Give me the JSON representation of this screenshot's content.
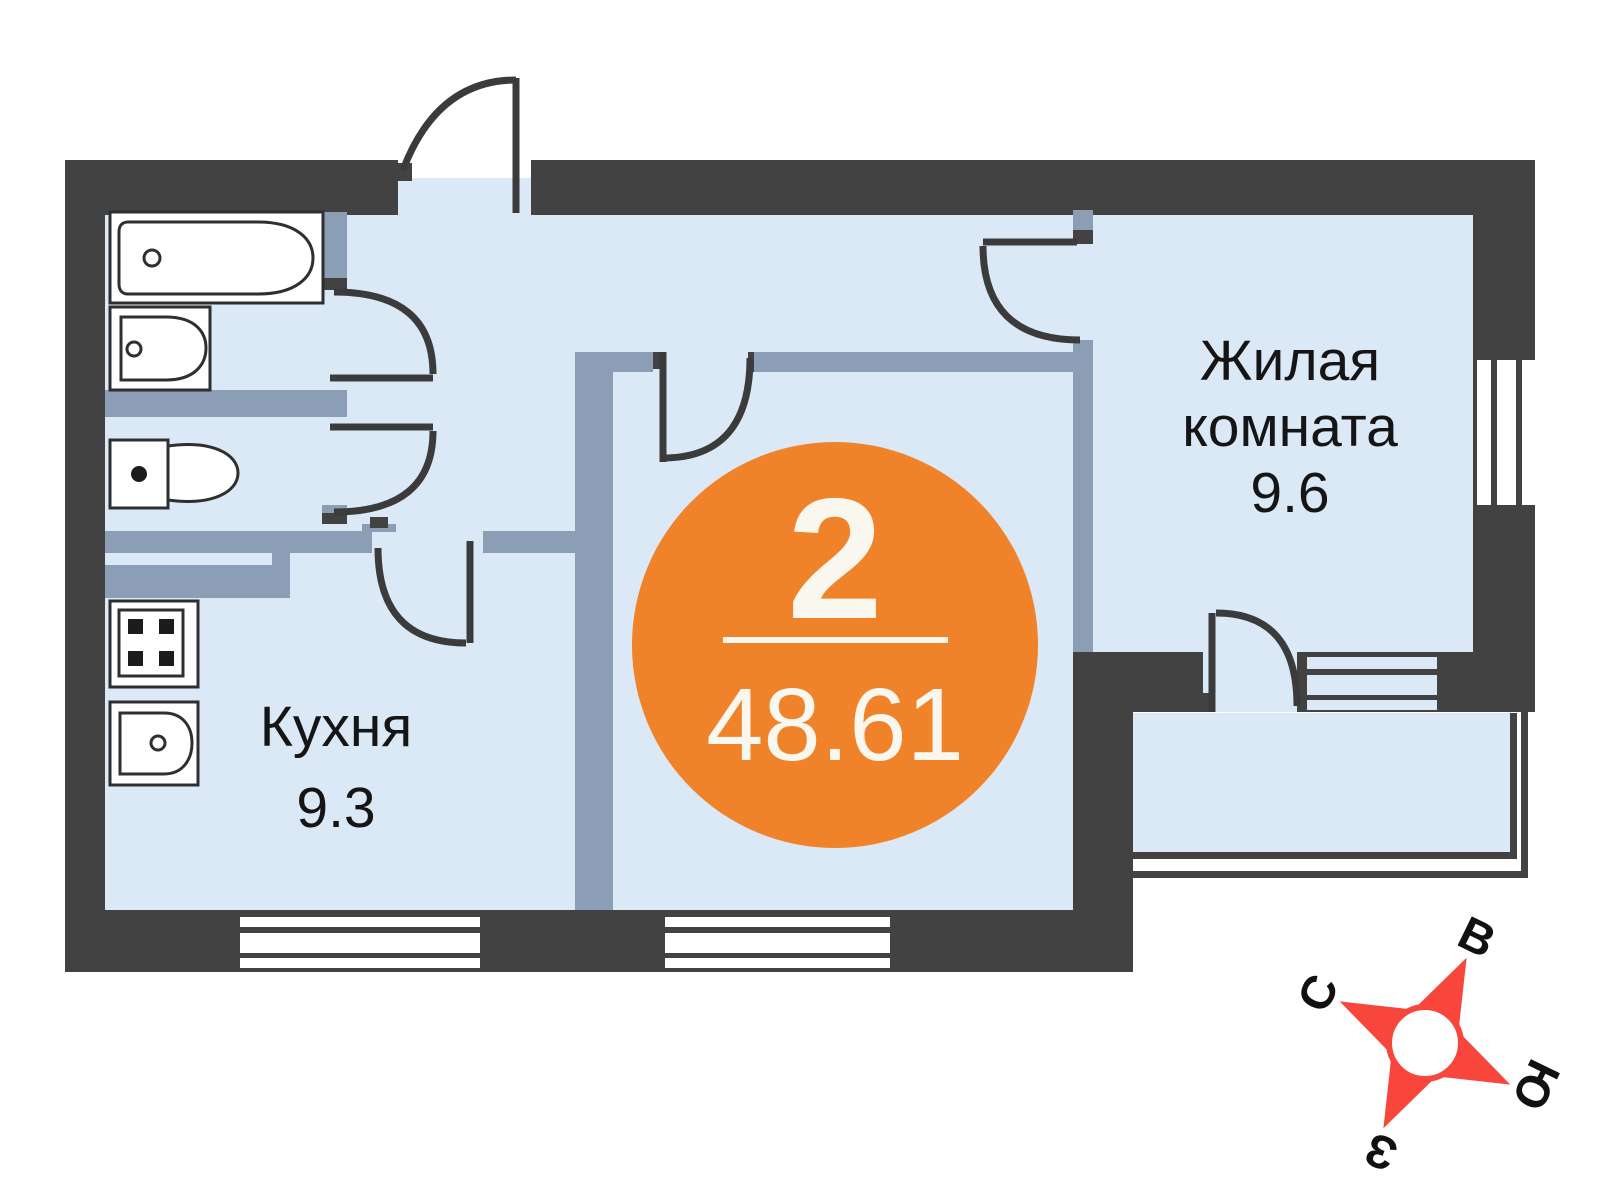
{
  "title": "2-room apartment floor plan",
  "badge": {
    "rooms_count": "2",
    "total_area": "48.61"
  },
  "rooms": [
    {
      "id": "living-room",
      "label_lines": [
        "Жилая",
        "комната"
      ],
      "area": "9.6"
    },
    {
      "id": "kitchen",
      "label_lines": [
        "Кухня"
      ],
      "area": "9.3"
    }
  ],
  "compass": {
    "north": "С",
    "east": "В",
    "south": "Ю",
    "west": "З"
  },
  "icons": [
    "bathtub-icon",
    "washbasin-icon",
    "toilet-icon",
    "stove-icon",
    "kitchen-sink-icon",
    "compass-rose-icon"
  ],
  "theme": {
    "wall_dark": "#424242",
    "wall_inner": "#8C9DB6",
    "floor": "#DBE9F7",
    "accent_orange": "#F0822A",
    "badge_text": "#FAF7EE",
    "compass_red": "#F8463C",
    "text": "#151515",
    "fixture_stroke": "#2F2F2F",
    "white": "#FFFFFF"
  }
}
